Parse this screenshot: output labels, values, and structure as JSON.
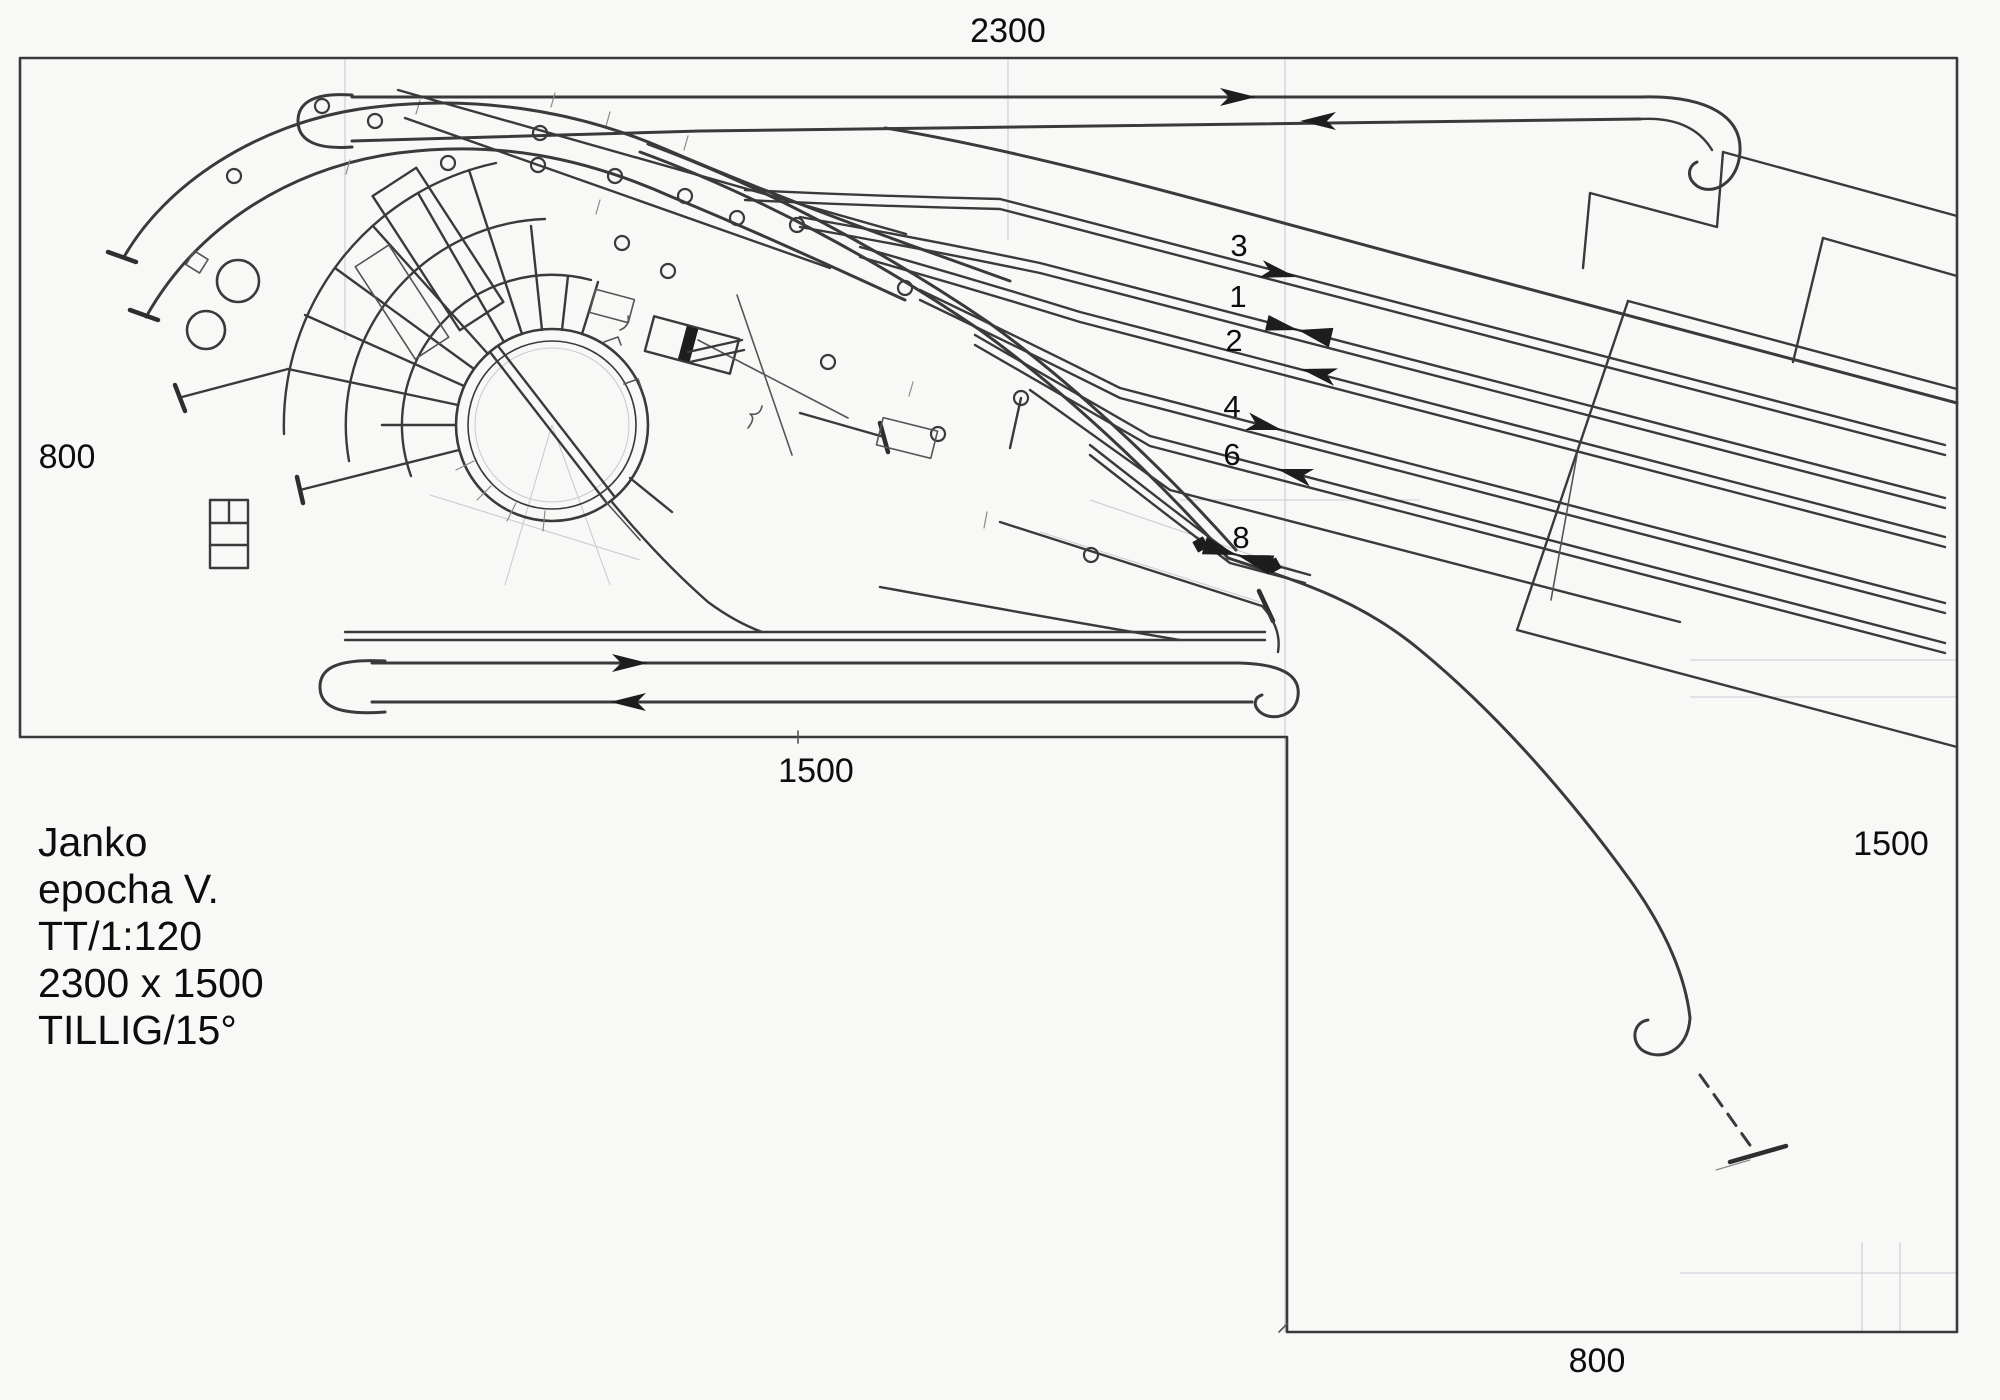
{
  "document": {
    "type": "scanned hand-drawn model railway track plan",
    "paper_color": "#f8f8f6",
    "ink_color": "#3a3a3a",
    "text_color": "#0d0d0d",
    "faint_guide_color": "#c7cdd6"
  },
  "dimensions": {
    "top": "2300",
    "left": "800",
    "bottom_inner": "1500",
    "right": "1500",
    "bottom_outer": "800"
  },
  "title_block": {
    "line1": "Janko",
    "line2": "epocha V.",
    "line3": "TT/1:120",
    "line4": "2300 x 1500",
    "line5": "TILLIG/15°"
  },
  "track_numbers": {
    "t3": "3",
    "t1": "1",
    "t2": "2",
    "t4": "4",
    "t6": "6",
    "t8": "8"
  },
  "symbols": {
    "right_arrow": "direction-arrow-right",
    "left_arrow": "direction-arrow-left",
    "bowtie": "double-direction-arrow",
    "loop_hook": "return-loop-hook",
    "t_bar": "track-end-buffer",
    "switch_circle": "turnout-motor-circle",
    "turntable": "turntable-with-roundhouse"
  }
}
